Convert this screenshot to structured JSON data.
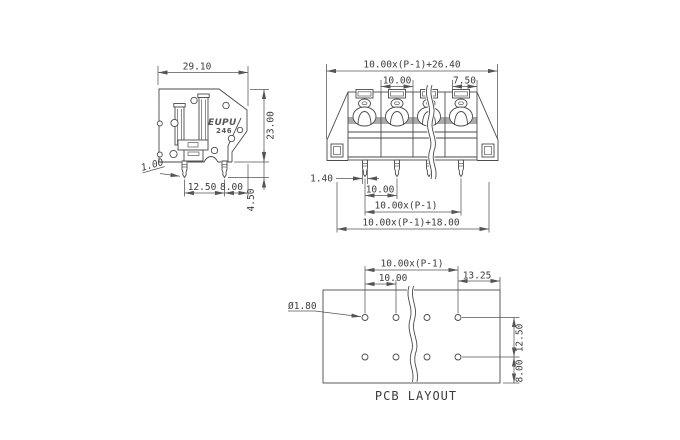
{
  "drawing": {
    "side_view": {
      "width": "29.10",
      "height": "23.00",
      "lead_thickness": "1.00",
      "lead_spacing": "12.50",
      "lead_edge_offset": "8.00",
      "lead_length": "4.50",
      "logo_brand": "EUPU",
      "logo_model": "246"
    },
    "front_view": {
      "overall_width": "10.00x(P-1)+26.40",
      "pole_pitch": "10.00",
      "end_segment": "7.50",
      "pin_width": "1.40",
      "pin_pitch": "10.00",
      "pin_span": "10.00x(P-1)",
      "outer_span": "10.00x(P-1)+18.00"
    },
    "pcb_layout": {
      "caption": "PCB LAYOUT",
      "hole_span": "10.00x(P-1)",
      "hole_pitch": "10.00",
      "edge_offset": "13.25",
      "hole_diameter": "Ø1.80",
      "row_spacing": "12.50",
      "row_edge_offset": "8.00"
    }
  }
}
